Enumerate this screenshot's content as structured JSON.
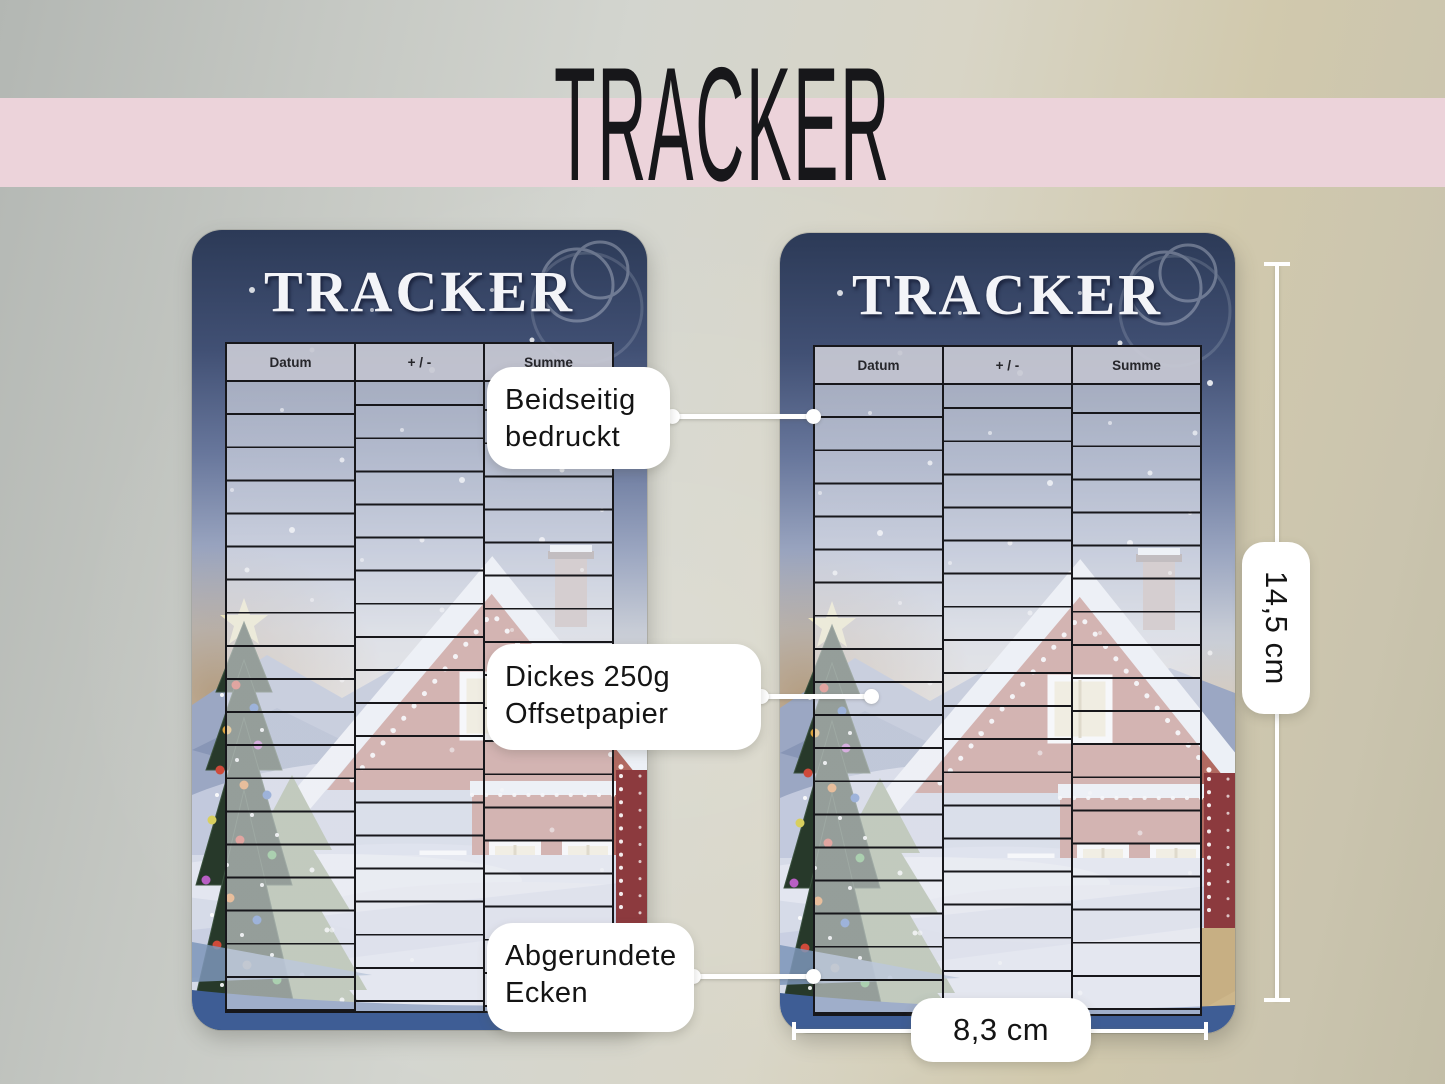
{
  "banner": {
    "title": "TRACKER"
  },
  "card": {
    "title": "TRACKER",
    "table": {
      "columns": [
        "Datum",
        "+ / -",
        "Summe"
      ],
      "row_count": 19
    }
  },
  "callouts": {
    "double_sided": {
      "line1": "Beidseitig",
      "line2": "bedruckt"
    },
    "paper": {
      "line1": "Dickes 250g",
      "line2": "Offsetpapier"
    },
    "corners": {
      "line1": "Abgerundete",
      "line2": "Ecken"
    }
  },
  "measurements": {
    "height": "14,5 cm",
    "width": "8,3 cm"
  },
  "colors": {
    "banner_pink": "#ecd3da",
    "night_sky_blue": "#2c3a57",
    "card_rim_blue": "#3e5d95",
    "house_red": "#b16a61",
    "callout_white": "#ffffff"
  }
}
